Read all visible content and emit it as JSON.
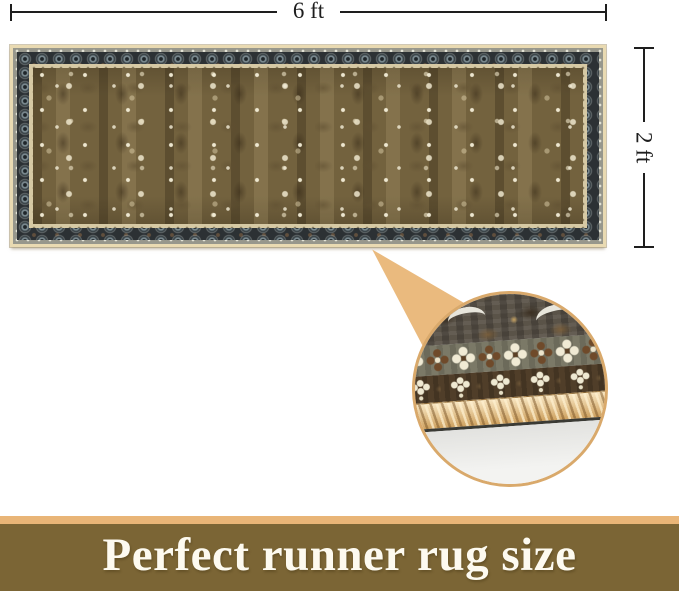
{
  "dimensions": {
    "width_label": "6 ft",
    "height_label": "2 ft"
  },
  "banner": {
    "text": "Perfect runner rug size"
  },
  "colors": {
    "dimension_line": "#1e1e1e",
    "callout_fill": "#eaba7e",
    "callout_ring": "#d9a96b",
    "rug_binding": "#e9dab2",
    "rug_border_outer_strip": "#97978c",
    "rug_border_dark": "#2c3134",
    "rug_border_inner_strip": "#d6c9a4",
    "rug_field": "#73623e",
    "rope_trim": "#e2ba7c",
    "floor": "#f3f3f1",
    "banner_strip": "#e9b577",
    "banner_bg": "#7b6535",
    "banner_text": "#fdfaf0"
  }
}
